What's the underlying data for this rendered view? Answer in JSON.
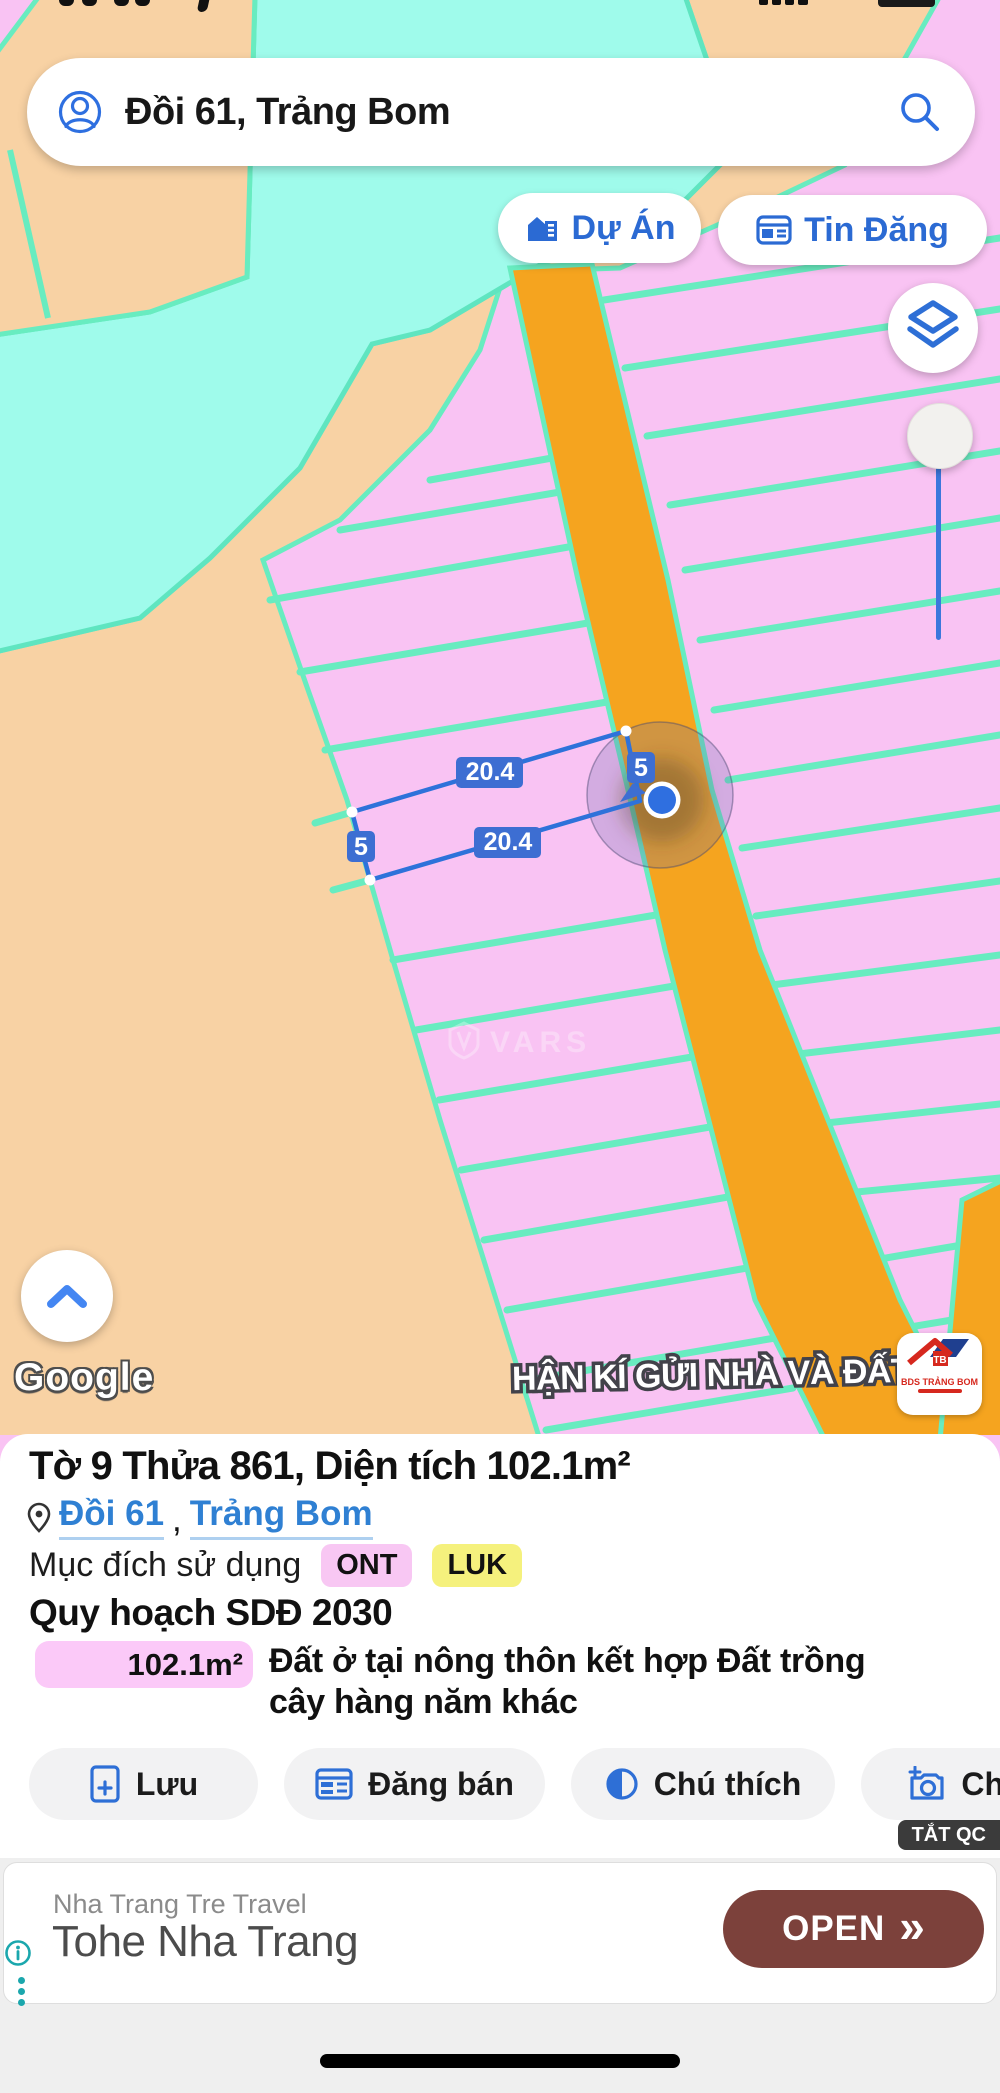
{
  "search": {
    "value": "Đồi 61, Trảng Bom"
  },
  "map": {
    "buttons": {
      "du_an": "Dự Án",
      "tin_dang": "Tin Đăng"
    },
    "measurements": {
      "top": "20.4",
      "right": "5",
      "bottom": "20.4",
      "left": "5"
    },
    "watermark_small": "VARS",
    "watermark_banner": "HẬN KÍ GỬI NHÀ VÀ ĐẤT",
    "google_label": "Google",
    "partner_logo": {
      "title": "BDS TRẢNG BOM"
    },
    "colors": {
      "parcel_pink": "#f9c3f3",
      "parcel_tan": "#f8d2a4",
      "water_cyan": "#9ffbeb",
      "road_orange": "#f5a41f",
      "border_teal": "#68ecc0",
      "selection_blue": "#2e72da",
      "label_blue": "#3d6ed2",
      "location_dot": "#2f6fe0"
    }
  },
  "panel": {
    "title": "Tờ 9 Thửa 861, Diện tích 102.1m²",
    "location": {
      "link1": "Đồi 61",
      "comma": ",",
      "link2": "Trảng Bom"
    },
    "usage_label": "Mục đích sử dụng",
    "badges": [
      {
        "label": "ONT",
        "bg": "#f8c7f3"
      },
      {
        "label": "LUK",
        "bg": "#f5f17d"
      }
    ],
    "plan_heading": "Quy hoạch SDĐ 2030",
    "zone": {
      "area": "102.1m²",
      "color": "#fbc9f8",
      "description": "Đất ở tại nông thôn kết hợp Đất trồng cây hàng năm khác"
    },
    "actions": [
      {
        "label": "Lưu",
        "icon": "file-plus-icon"
      },
      {
        "label": "Đăng bán",
        "icon": "newspaper-icon"
      },
      {
        "label": "Chú thích",
        "icon": "contrast-icon"
      },
      {
        "label": "Chụ",
        "icon": "camera-plus-icon"
      }
    ]
  },
  "ad": {
    "close_label": "TẮT QC",
    "advertiser": "Nha Trang Tre Travel",
    "title": "Tohe Nha Trang",
    "cta": "OPEN",
    "cta_chevron": "»"
  }
}
